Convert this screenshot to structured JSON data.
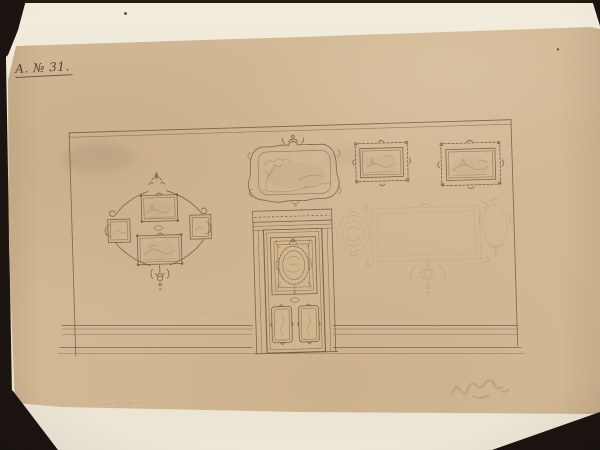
{
  "scene": {
    "description": "Photograph of a historical ornament drawing (wall elevation with door and picture frames) on tan paper over a cream backing sheet, dark background"
  },
  "colors": {
    "photo_background": "#1b1410",
    "backing_sheet": "#ece5d4",
    "drawing_paper": "#d2b894",
    "ink": "#6b573e",
    "pencil": "#a8947a",
    "stamp_green": "#7d8355"
  },
  "archive_label": {
    "text": "A. № 31."
  },
  "artwork": {
    "wall": "Wall elevation with cornice, dado rail and baseboard",
    "left_frame_group": "Rococo lozenge arrangement of four framed sketches with scrollwork",
    "overdoor": "Rococo cartouche panel with faint landscape sketch above the door",
    "door": "Panelled door with dentil cornice, oval rococo medallion panel and two lower cartouche panels",
    "right_framed_pictures": "Two ornate rectangular picture frames with landscape sketches",
    "pencil_panel": "Faint pencil sketch of a wall panel with corner ornaments, oval medallion and pendant",
    "stamp": "Faded green illegible stamp near lower right corner"
  }
}
